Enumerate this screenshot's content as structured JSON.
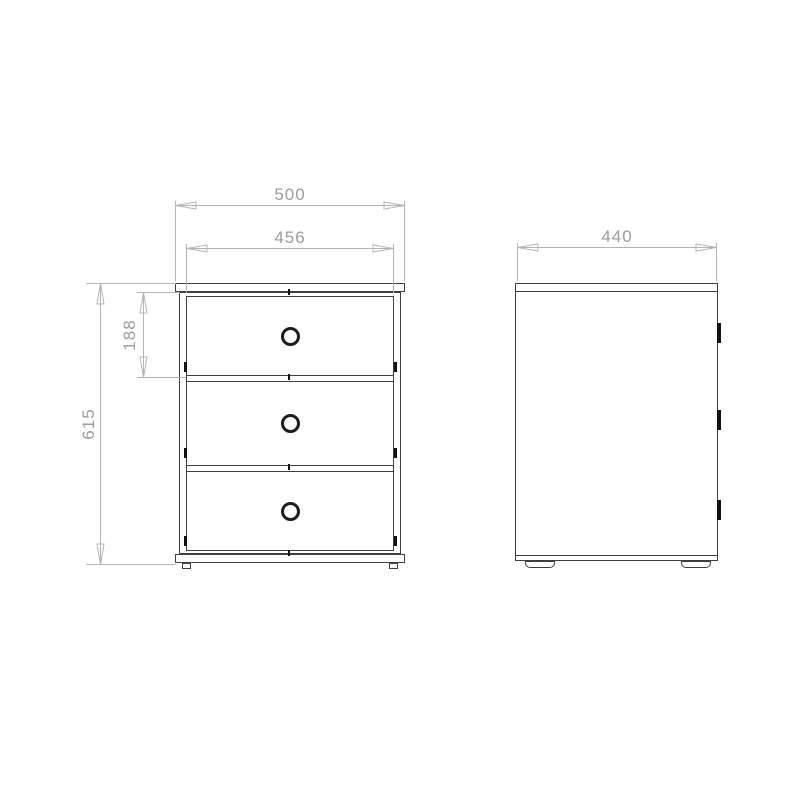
{
  "drawing": {
    "description": "two-view technical drawing of a three-drawer bedside chest",
    "views": {
      "front": {
        "drawer_count": 3
      },
      "side": {
        "front_edge_marks": 3
      }
    },
    "icons": {
      "drawer_knob": "open-ring",
      "dim_arrow": "open-triangle-arrowhead"
    }
  },
  "dimensions": {
    "overall_width": "500",
    "inner_width": "456",
    "overall_height": "615",
    "top_drawer_height": "188",
    "depth": "440"
  },
  "colors": {
    "outline": "#3f3f3f",
    "dim_line": "#b4b4b4",
    "dim_text": "#9c9c9c",
    "knob": "#1c1c1c",
    "mark": "#111111",
    "background": "#ffffff"
  }
}
